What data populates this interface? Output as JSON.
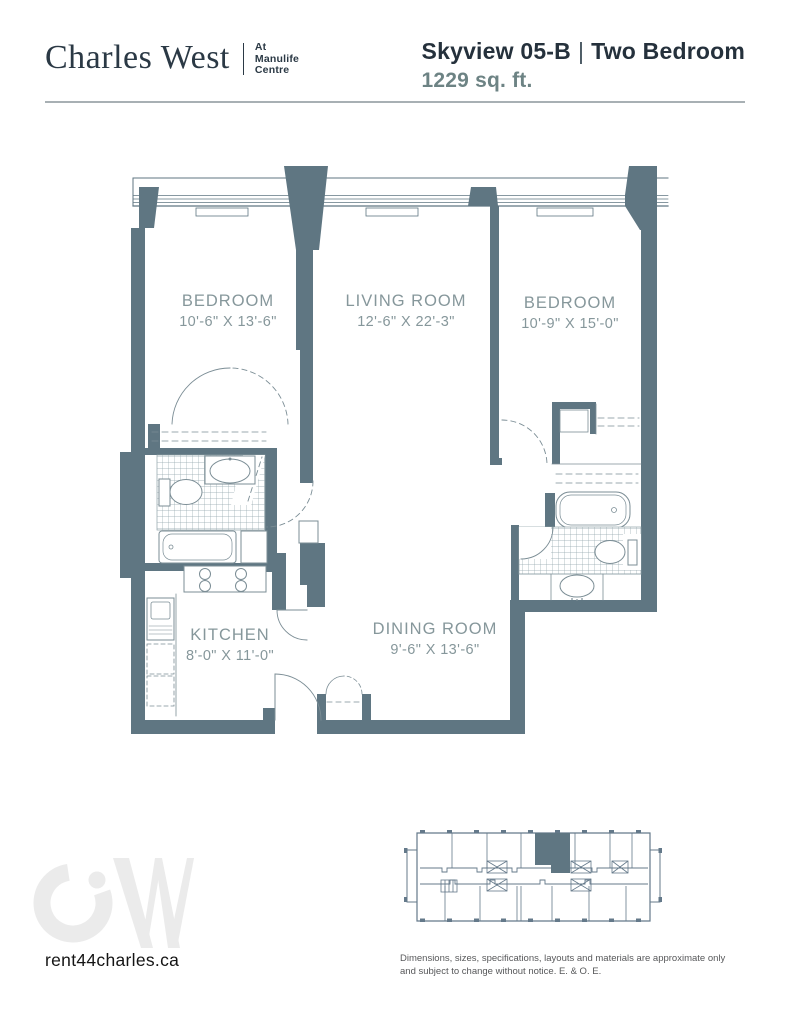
{
  "brand": {
    "name": "Charles West",
    "tagline": [
      "At",
      "Manulife",
      "Centre"
    ]
  },
  "header": {
    "plan_name": "Skyview 05-B",
    "separator": "|",
    "plan_type": "Two Bedroom",
    "area": "1229 sq. ft."
  },
  "rooms": [
    {
      "name": "BEDROOM",
      "dims": "10'-6\" X 13'-6\""
    },
    {
      "name": "LIVING ROOM",
      "dims": "12'-6\" X 22'-3\""
    },
    {
      "name": "BEDROOM",
      "dims": "10'-9\" X 15'-0\""
    },
    {
      "name": "KITCHEN",
      "dims": "8'-0\" X 11'-0\""
    },
    {
      "name": "DINING ROOM",
      "dims": "9'-6\" X 13'-6\""
    }
  ],
  "footer": {
    "website": "rent44charles.ca",
    "watermark": "CW",
    "disclaimer": [
      "Dimensions, sizes, specifications, layouts and materials are approximate only",
      "and subject to change without notice. E. & O. E."
    ]
  },
  "colors": {
    "wall": "#5f7682",
    "ink": "#25313c",
    "area_text": "#6d8384",
    "room_label": "#86979b",
    "watermark": "#ebebeb",
    "rule": "#a8b0b4",
    "disclaimer": "#57585a"
  }
}
